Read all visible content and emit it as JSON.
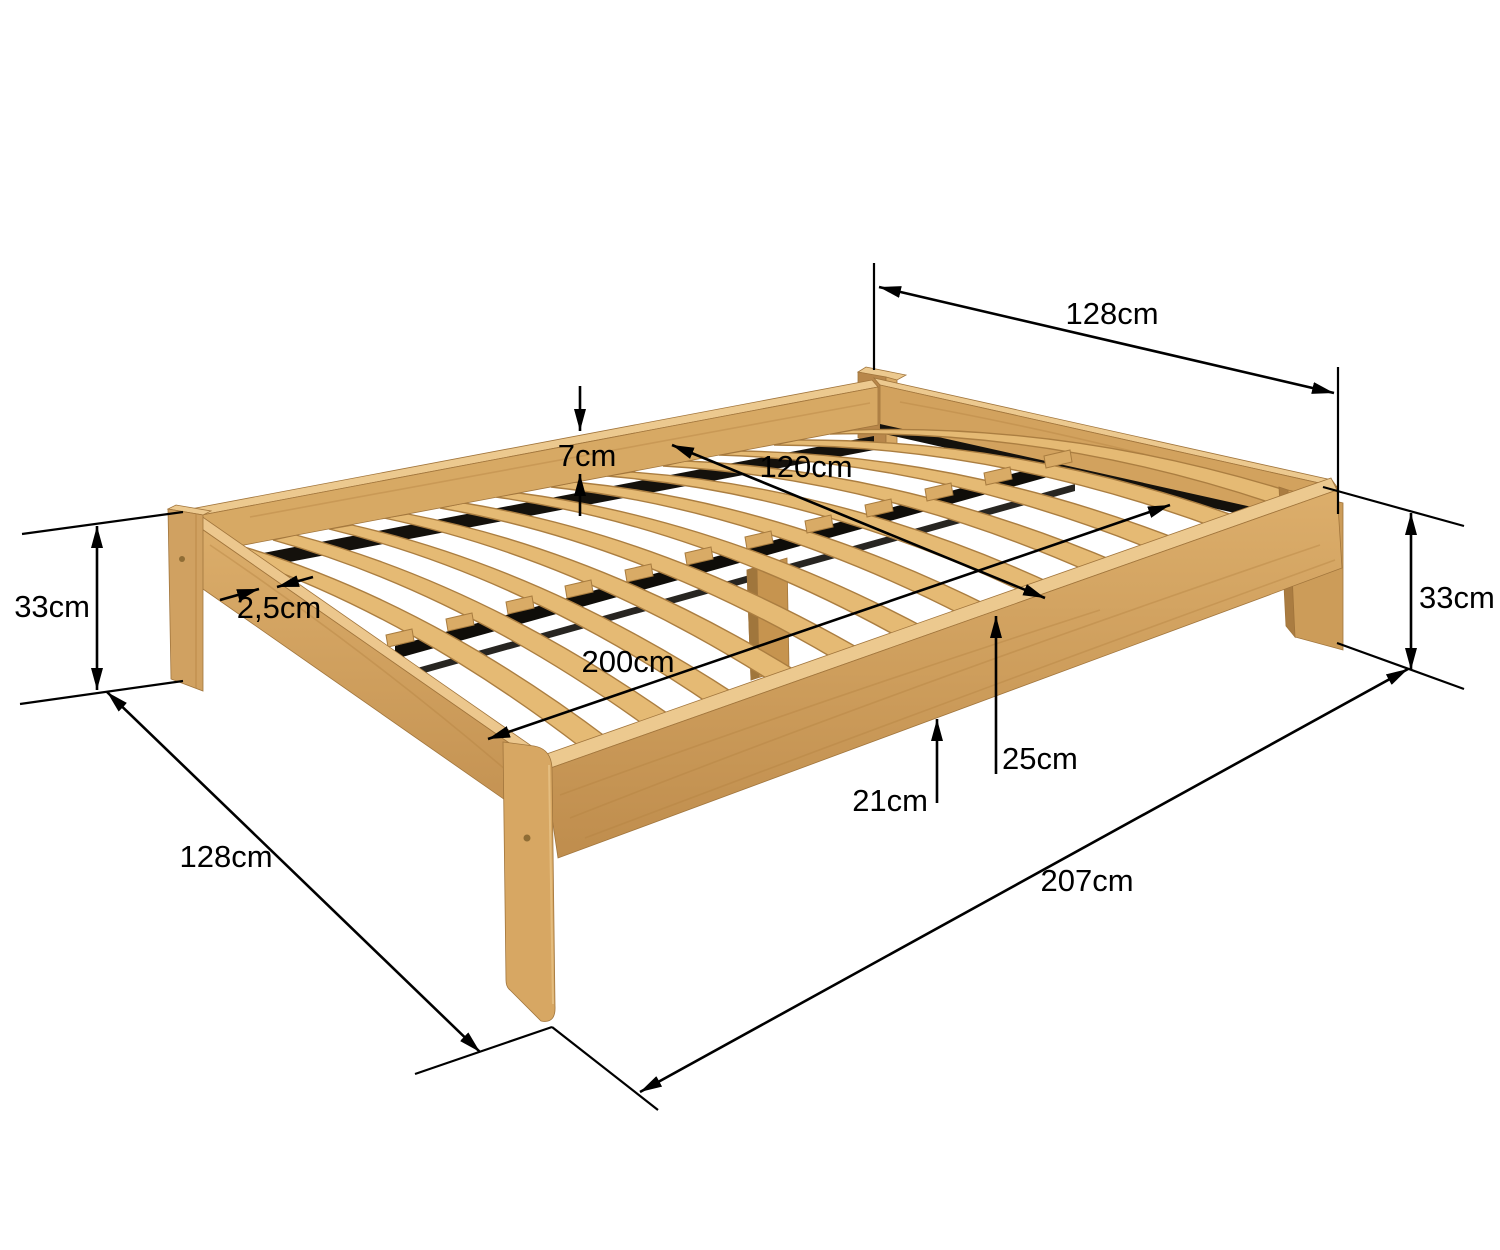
{
  "diagram": {
    "subject": "wooden slatted bed frame dimension diagram",
    "background_color": "#ffffff",
    "line_color": "#000000",
    "wood_colors": {
      "highlight": "#ecc98f",
      "light": "#e5ba74",
      "mid": "#d7a964",
      "dark": "#b9854a",
      "shadow_gap": "#14110c"
    },
    "measurements": {
      "head_end_width": "128cm",
      "side_rail_above_slats": "7cm",
      "slatted_base_width": "120cm",
      "slat_thickness": "2,5cm",
      "foot_leg_height": "33cm",
      "head_leg_height": "33cm",
      "slatted_base_length": "200cm",
      "slat_top_height": "25cm",
      "under_frame_clearance": "21cm",
      "foot_end_width": "128cm",
      "frame_total_length": "207cm"
    }
  }
}
